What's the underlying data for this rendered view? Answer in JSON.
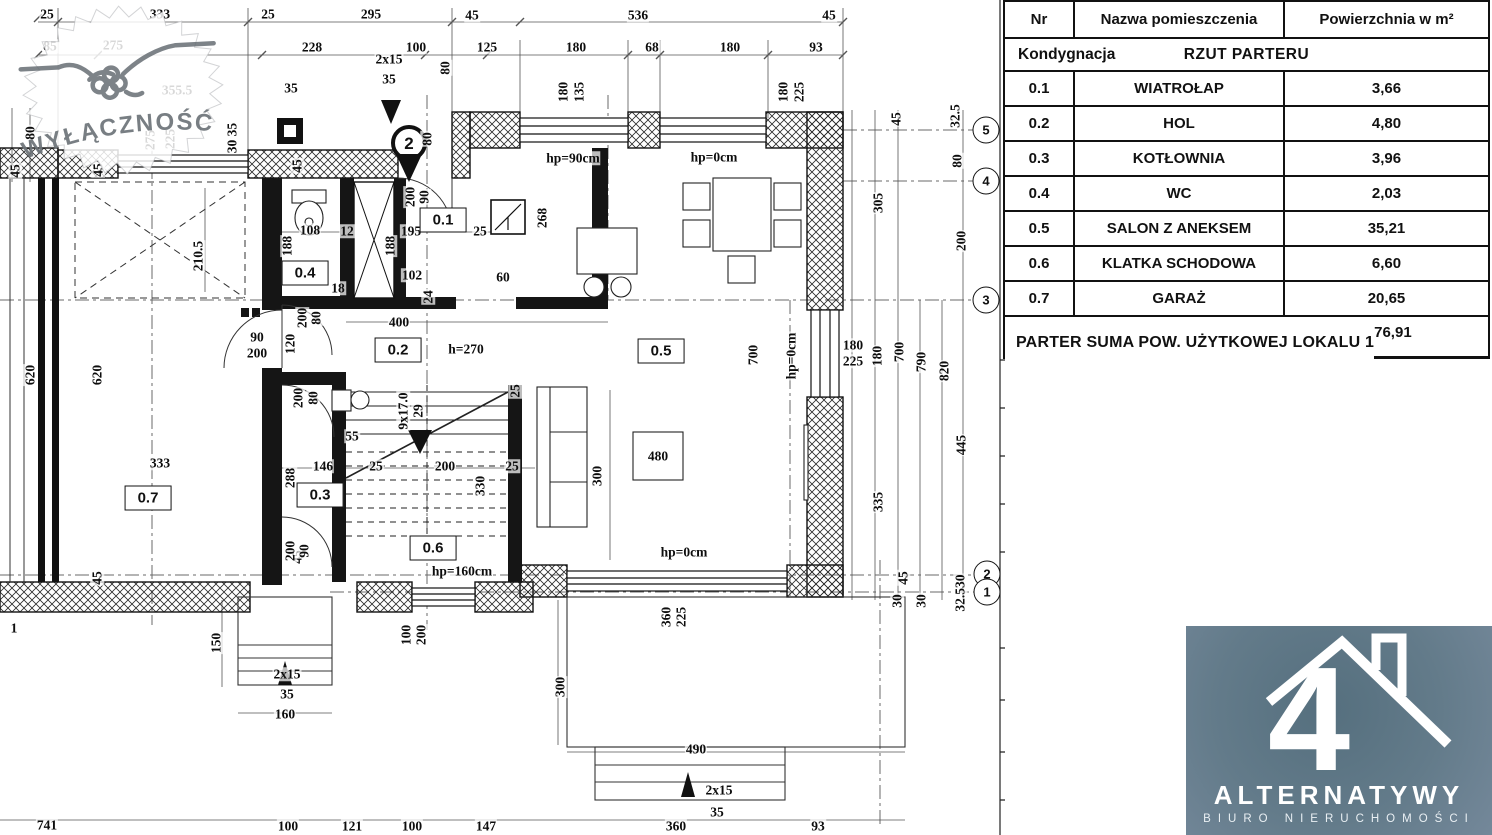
{
  "table": {
    "headers": {
      "nr": "Nr",
      "name": "Nazwa pomieszczenia",
      "area": "Powierzchnia w m²"
    },
    "storey_label": "Kondygnacja",
    "storey_value": "RZUT PARTERU",
    "rows": [
      {
        "nr": "0.1",
        "name": "WIATROŁAP",
        "area": "3,66"
      },
      {
        "nr": "0.2",
        "name": "HOL",
        "area": "4,80"
      },
      {
        "nr": "0.3",
        "name": "KOTŁOWNIA",
        "area": "3,96"
      },
      {
        "nr": "0.4",
        "name": "WC",
        "area": "2,03"
      },
      {
        "nr": "0.5",
        "name": "SALON Z ANEKSEM",
        "area": "35,21"
      },
      {
        "nr": "0.6",
        "name": "KLATKA SCHODOWA",
        "area": "6,60"
      },
      {
        "nr": "0.7",
        "name": "GARAŻ",
        "area": "20,65"
      }
    ],
    "summary_label": "PARTER  SUMA POW. UŻYTKOWEJ LOKALU 1",
    "summary_value": "76,91"
  },
  "watermark": {
    "text": "WYŁĄCZNOŚĆ",
    "icon": "handshake-icon"
  },
  "logo": {
    "big_glyph": "4",
    "brand": "ALTERNATYWY",
    "subtitle": "BIURO NIERUCHOMOŚCI",
    "bg_color": "#637b8a",
    "fg_color": "#ffffff"
  },
  "plan": {
    "title": "RZUT PARTERU",
    "pin_marker": {
      "n": "2"
    },
    "grid_markers": [
      {
        "n": "5",
        "x": 986,
        "y": 130
      },
      {
        "n": "4",
        "x": 986,
        "y": 181
      },
      {
        "n": "3",
        "x": 986,
        "y": 300
      },
      {
        "n": "2",
        "x": 987,
        "y": 574
      },
      {
        "n": "1",
        "x": 987,
        "y": 592
      }
    ],
    "rooms": [
      {
        "id": "0.1",
        "x": 443,
        "y": 220
      },
      {
        "id": "0.2",
        "x": 398,
        "y": 350
      },
      {
        "id": "0.3",
        "x": 320,
        "y": 495
      },
      {
        "id": "0.4",
        "x": 305,
        "y": 273
      },
      {
        "id": "0.5",
        "x": 661,
        "y": 351
      },
      {
        "id": "0.6",
        "x": 433,
        "y": 548
      },
      {
        "id": "0.7",
        "x": 148,
        "y": 498
      }
    ],
    "labels": [
      {
        "t": "25",
        "x": 47,
        "y": 14
      },
      {
        "t": "333",
        "x": 160,
        "y": 14
      },
      {
        "t": "25",
        "x": 268,
        "y": 14
      },
      {
        "t": "295",
        "x": 371,
        "y": 14
      },
      {
        "t": "45",
        "x": 472,
        "y": 15
      },
      {
        "t": "536",
        "x": 638,
        "y": 15
      },
      {
        "t": "45",
        "x": 829,
        "y": 15
      },
      {
        "t": "85",
        "x": 50,
        "y": 46
      },
      {
        "t": "275",
        "x": 113,
        "y": 45
      },
      {
        "t": "228",
        "x": 312,
        "y": 47
      },
      {
        "t": "100",
        "x": 416,
        "y": 47
      },
      {
        "t": "125",
        "x": 487,
        "y": 47
      },
      {
        "t": "180",
        "x": 576,
        "y": 47
      },
      {
        "t": "68",
        "x": 652,
        "y": 47
      },
      {
        "t": "180",
        "x": 730,
        "y": 47
      },
      {
        "t": "93",
        "x": 816,
        "y": 47
      },
      {
        "t": "2x15",
        "x": 389,
        "y": 59
      },
      {
        "t": "35",
        "x": 389,
        "y": 79
      },
      {
        "t": "355.5",
        "x": 177,
        "y": 90
      },
      {
        "t": "35",
        "x": 291,
        "y": 88
      },
      {
        "t": "80",
        "x": 445,
        "y": 68,
        "r": 1
      },
      {
        "t": "80",
        "x": 427,
        "y": 139,
        "r": 1
      },
      {
        "t": "180",
        "x": 563,
        "y": 92,
        "r": 1
      },
      {
        "t": "135",
        "x": 579,
        "y": 92,
        "r": 1
      },
      {
        "t": "180",
        "x": 783,
        "y": 92,
        "r": 1
      },
      {
        "t": "225",
        "x": 799,
        "y": 92,
        "r": 1
      },
      {
        "t": "hp=90cm",
        "x": 573,
        "y": 158
      },
      {
        "t": "hp=0cm",
        "x": 714,
        "y": 157
      },
      {
        "t": "80",
        "x": 30,
        "y": 133,
        "r": 1
      },
      {
        "t": "45",
        "x": 15,
        "y": 171,
        "r": 1
      },
      {
        "t": "275",
        "x": 150,
        "y": 140,
        "r": 1
      },
      {
        "t": "225",
        "x": 170,
        "y": 139,
        "r": 1
      },
      {
        "t": "30 35",
        "x": 232,
        "y": 138,
        "r": 1
      },
      {
        "t": "45",
        "x": 98,
        "y": 170,
        "r": 1
      },
      {
        "t": "45",
        "x": 297,
        "y": 166,
        "r": 1
      },
      {
        "t": "620",
        "x": 30,
        "y": 375,
        "r": 1
      },
      {
        "t": "620",
        "x": 97,
        "y": 375,
        "r": 1
      },
      {
        "t": "210.5",
        "x": 198,
        "y": 256,
        "r": 1
      },
      {
        "t": "333",
        "x": 160,
        "y": 463
      },
      {
        "t": "45",
        "x": 297,
        "y": 557,
        "r": 1
      },
      {
        "t": "45",
        "x": 97,
        "y": 578,
        "r": 1
      },
      {
        "t": "1",
        "x": 14,
        "y": 628
      },
      {
        "t": "108",
        "x": 310,
        "y": 230
      },
      {
        "t": "188",
        "x": 287,
        "y": 246,
        "r": 1
      },
      {
        "t": "12",
        "x": 347,
        "y": 231
      },
      {
        "t": "188",
        "x": 390,
        "y": 246,
        "r": 1
      },
      {
        "t": "195",
        "x": 411,
        "y": 231
      },
      {
        "t": "25",
        "x": 480,
        "y": 231
      },
      {
        "t": "200",
        "x": 410,
        "y": 197,
        "r": 1
      },
      {
        "t": "90",
        "x": 424,
        "y": 197,
        "r": 1
      },
      {
        "t": "102",
        "x": 412,
        "y": 275
      },
      {
        "t": "60",
        "x": 503,
        "y": 277
      },
      {
        "t": "24",
        "x": 428,
        "y": 297,
        "r": 1
      },
      {
        "t": "18",
        "x": 338,
        "y": 288
      },
      {
        "t": "400",
        "x": 399,
        "y": 322
      },
      {
        "t": "h=270",
        "x": 466,
        "y": 349
      },
      {
        "t": "90",
        "x": 257,
        "y": 337
      },
      {
        "t": "200",
        "x": 257,
        "y": 353
      },
      {
        "t": "120",
        "x": 290,
        "y": 344,
        "r": 1
      },
      {
        "t": "200",
        "x": 302,
        "y": 318,
        "r": 1
      },
      {
        "t": "80",
        "x": 316,
        "y": 318,
        "r": 1
      },
      {
        "t": "200",
        "x": 298,
        "y": 398,
        "r": 1
      },
      {
        "t": "80",
        "x": 313,
        "y": 398,
        "r": 1
      },
      {
        "t": "55",
        "x": 352,
        "y": 436
      },
      {
        "t": "146",
        "x": 323,
        "y": 466
      },
      {
        "t": "25",
        "x": 376,
        "y": 466
      },
      {
        "t": "200",
        "x": 445,
        "y": 466
      },
      {
        "t": "25",
        "x": 512,
        "y": 466
      },
      {
        "t": "330",
        "x": 480,
        "y": 486,
        "r": 1
      },
      {
        "t": "288",
        "x": 290,
        "y": 478,
        "r": 1
      },
      {
        "t": "9x17.0",
        "x": 403,
        "y": 411,
        "r": 1
      },
      {
        "t": "29",
        "x": 418,
        "y": 411,
        "r": 1
      },
      {
        "t": "200",
        "x": 290,
        "y": 551,
        "r": 1
      },
      {
        "t": "90",
        "x": 304,
        "y": 551,
        "r": 1
      },
      {
        "t": "hp=160cm",
        "x": 462,
        "y": 571
      },
      {
        "t": "268",
        "x": 542,
        "y": 218,
        "r": 1
      },
      {
        "t": "700",
        "x": 753,
        "y": 355,
        "r": 1
      },
      {
        "t": "hp=0cm",
        "x": 791,
        "y": 356,
        "r": 1
      },
      {
        "t": "300",
        "x": 597,
        "y": 476,
        "r": 1
      },
      {
        "t": "480",
        "x": 658,
        "y": 456
      },
      {
        "t": "25",
        "x": 515,
        "y": 391,
        "r": 1
      },
      {
        "t": "180",
        "x": 853,
        "y": 345
      },
      {
        "t": "225",
        "x": 853,
        "y": 361
      },
      {
        "t": "180",
        "x": 877,
        "y": 356,
        "r": 1
      },
      {
        "t": "700",
        "x": 899,
        "y": 352,
        "r": 1
      },
      {
        "t": "790",
        "x": 921,
        "y": 362,
        "r": 1
      },
      {
        "t": "820",
        "x": 944,
        "y": 371,
        "r": 1
      },
      {
        "t": "45",
        "x": 896,
        "y": 119,
        "r": 1
      },
      {
        "t": "32.5",
        "x": 955,
        "y": 116,
        "r": 1
      },
      {
        "t": "80",
        "x": 957,
        "y": 161,
        "r": 1
      },
      {
        "t": "305",
        "x": 878,
        "y": 203,
        "r": 1
      },
      {
        "t": "200",
        "x": 961,
        "y": 241,
        "r": 1
      },
      {
        "t": "445",
        "x": 961,
        "y": 445,
        "r": 1
      },
      {
        "t": "335",
        "x": 878,
        "y": 502,
        "r": 1
      },
      {
        "t": "45",
        "x": 903,
        "y": 578,
        "r": 1
      },
      {
        "t": "30",
        "x": 897,
        "y": 601,
        "r": 1
      },
      {
        "t": "30",
        "x": 921,
        "y": 601,
        "r": 1
      },
      {
        "t": "32.530",
        "x": 960,
        "y": 593,
        "r": 1
      },
      {
        "t": "360",
        "x": 666,
        "y": 617,
        "r": 1
      },
      {
        "t": "225",
        "x": 681,
        "y": 617,
        "r": 1
      },
      {
        "t": "300",
        "x": 560,
        "y": 687,
        "r": 1
      },
      {
        "t": "hp=0cm",
        "x": 684,
        "y": 552
      },
      {
        "t": "490",
        "x": 696,
        "y": 749
      },
      {
        "t": "2x15",
        "x": 719,
        "y": 790
      },
      {
        "t": "35",
        "x": 717,
        "y": 812
      },
      {
        "t": "150",
        "x": 216,
        "y": 643,
        "r": 1
      },
      {
        "t": "2x15",
        "x": 287,
        "y": 674
      },
      {
        "t": "35",
        "x": 287,
        "y": 694
      },
      {
        "t": "160",
        "x": 285,
        "y": 714
      },
      {
        "t": "100",
        "x": 406,
        "y": 635,
        "r": 1
      },
      {
        "t": "200",
        "x": 421,
        "y": 635,
        "r": 1
      },
      {
        "t": "741",
        "x": 47,
        "y": 825
      },
      {
        "t": "100",
        "x": 288,
        "y": 826
      },
      {
        "t": "121",
        "x": 352,
        "y": 826
      },
      {
        "t": "100",
        "x": 412,
        "y": 826
      },
      {
        "t": "147",
        "x": 486,
        "y": 826
      },
      {
        "t": "360",
        "x": 676,
        "y": 826
      },
      {
        "t": "93",
        "x": 818,
        "y": 826
      }
    ]
  }
}
